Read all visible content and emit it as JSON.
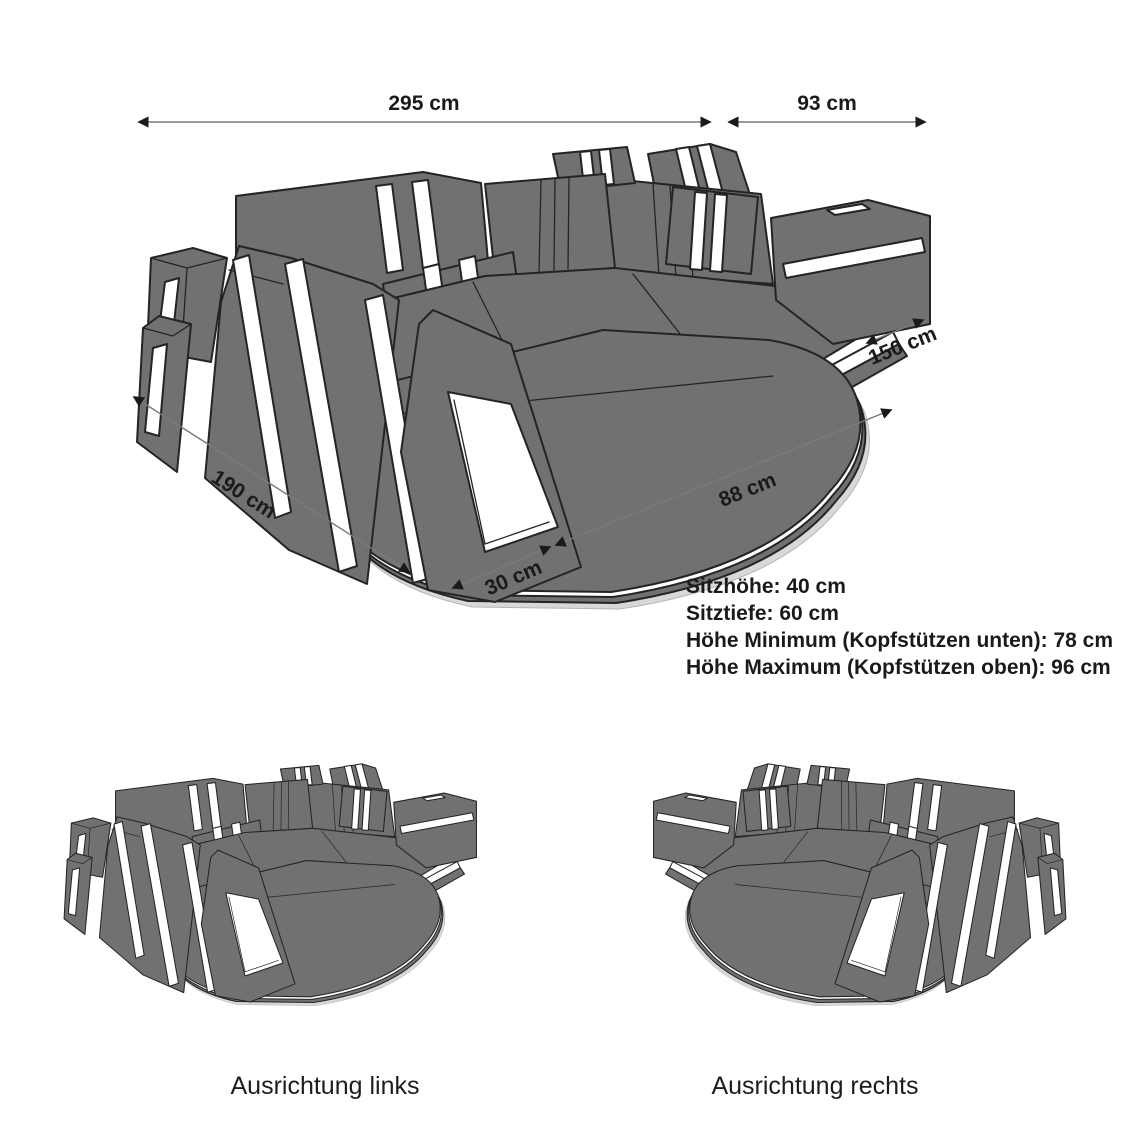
{
  "diagram": {
    "dimensions": {
      "total_width": "295 cm",
      "corner_width": "93 cm",
      "chaise_width": "150 cm",
      "total_depth": "190 cm",
      "front_right": "88 cm",
      "front_left": "30 cm"
    },
    "specs": {
      "seat_height": "Sitzhöhe: 40 cm",
      "seat_depth": "Sitztiefe: 60 cm",
      "height_min": "Höhe Minimum (Kopfstützen unten): 78 cm",
      "height_max": "Höhe Maximum (Kopfstützen oben): 96 cm"
    },
    "variants": {
      "left": "Ausrichtung links",
      "right": "Ausrichtung rechts"
    },
    "colors": {
      "sofa_fill": "#6f7173",
      "outline": "#242424",
      "accent_stripe": "#ffffff",
      "text": "#1a1a1a",
      "background": "#ffffff"
    }
  }
}
